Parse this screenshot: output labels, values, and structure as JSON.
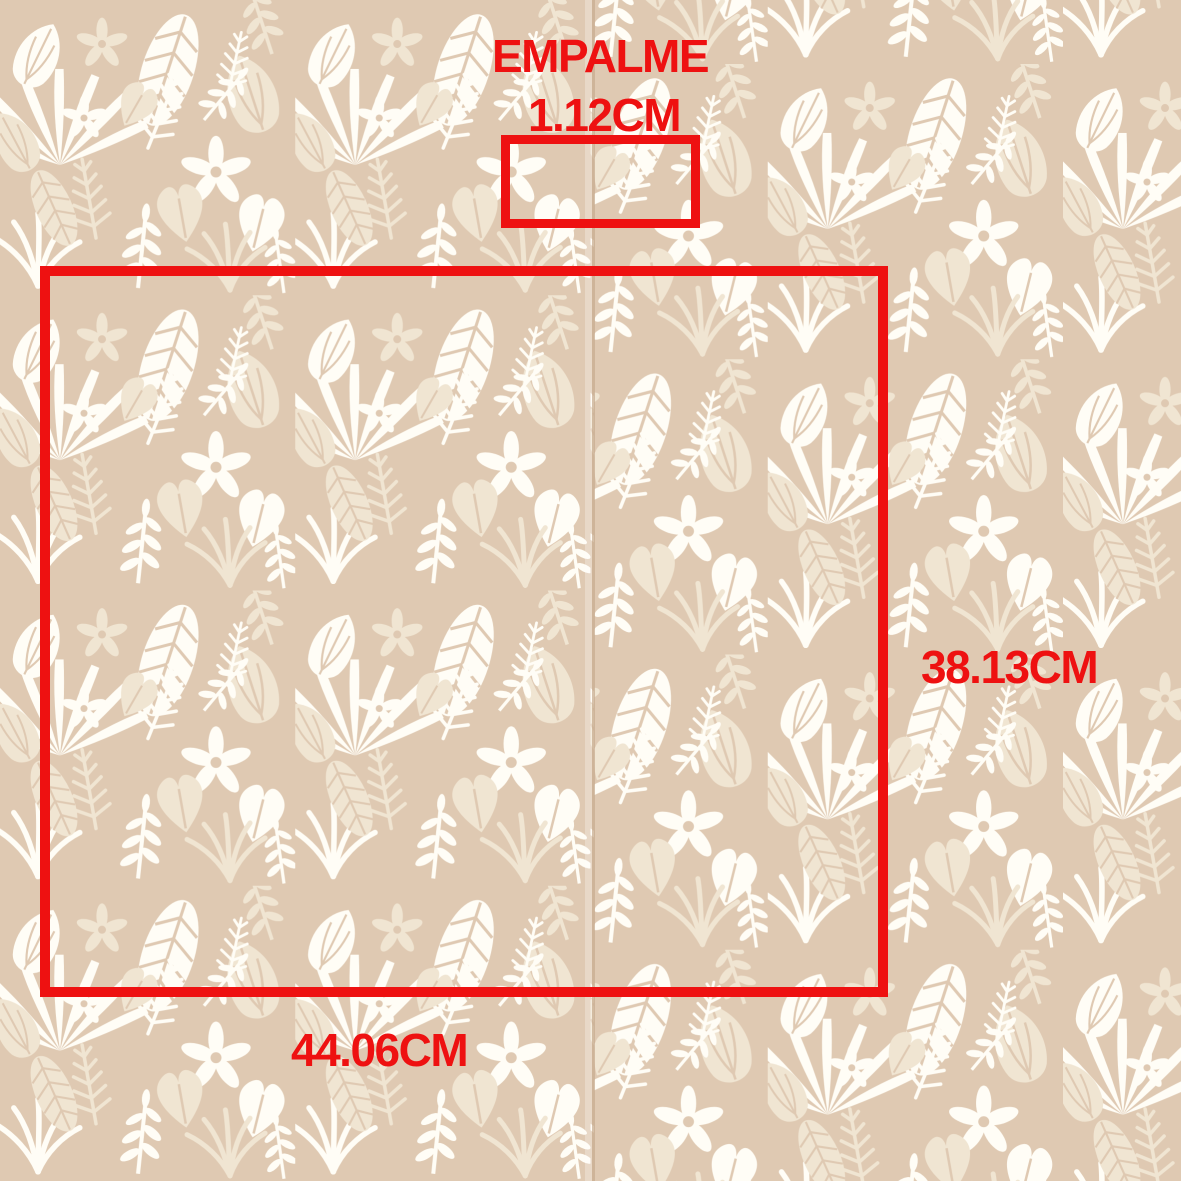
{
  "image": {
    "kind": "wallpaper-pattern-measurement-diagram",
    "background_color": "#dfc9b2",
    "pattern": {
      "description": "tropical-leaves-wallpaper",
      "leaf_white": "#fffdf6",
      "leaf_cream": "#f0e5d2",
      "vein_color": "#dfc9b2",
      "seam_line_color": "#c8ac90"
    }
  },
  "annotations": {
    "color": "#ee1111",
    "seam_label": "EMPALME",
    "seam_size": "1.12CM",
    "repeat_height": "38.13CM",
    "repeat_width": "44.06CM"
  }
}
